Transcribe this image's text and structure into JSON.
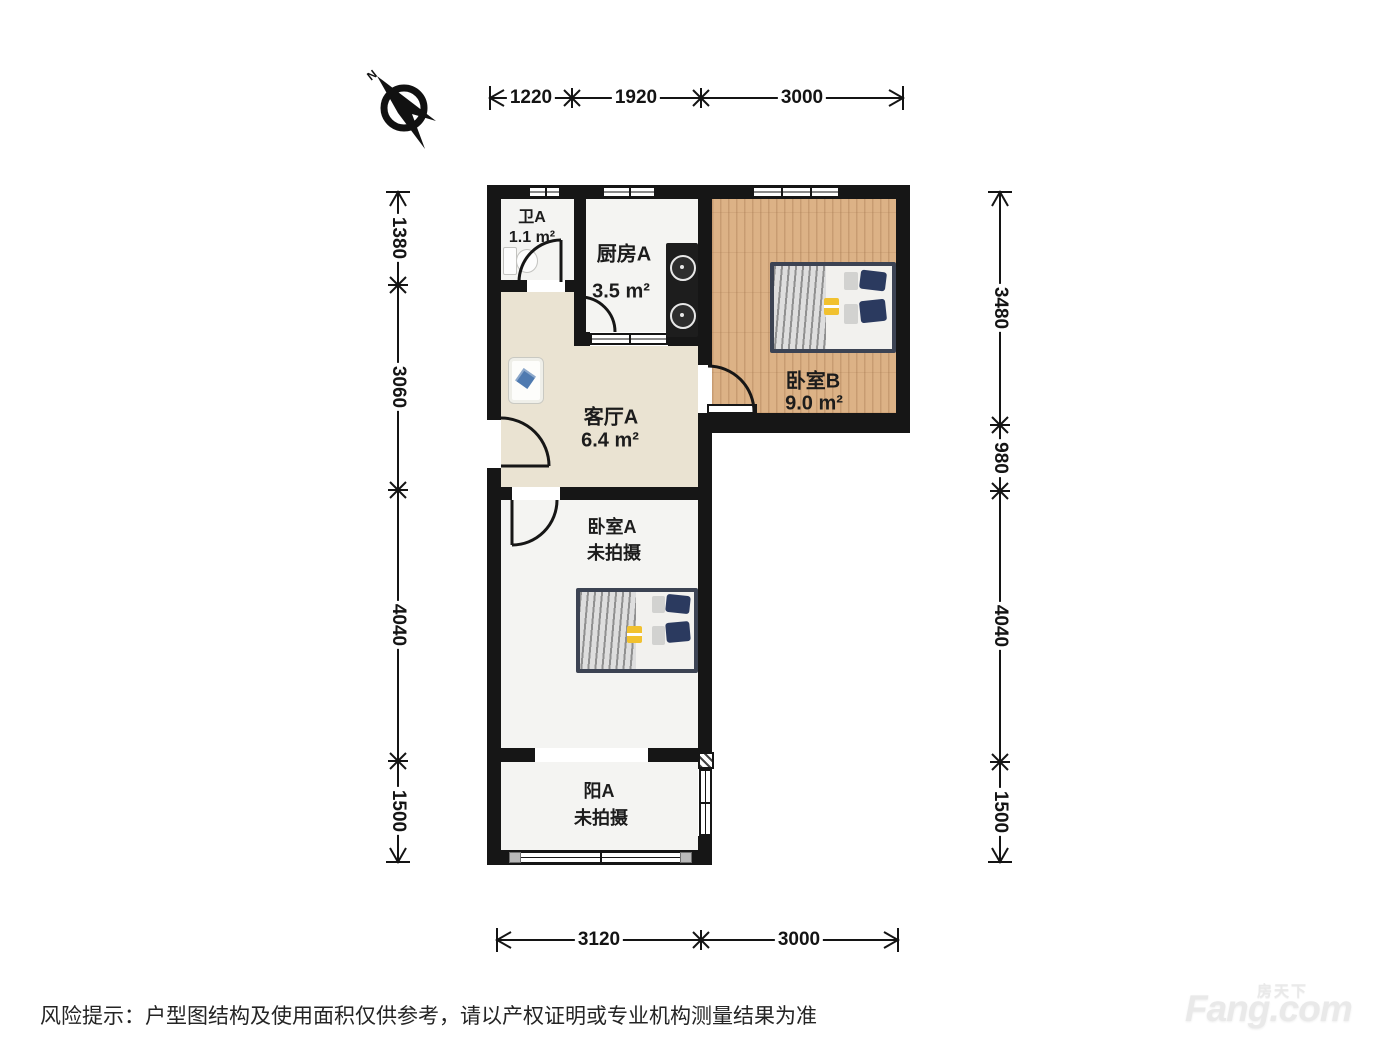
{
  "compass": {
    "label": "N"
  },
  "rooms": [
    {
      "id": "bath",
      "name": "卫A",
      "area": "1.1 m²"
    },
    {
      "id": "kitchen",
      "name": "厨房A",
      "area": "3.5 m²"
    },
    {
      "id": "bedroomB",
      "name": "卧室B",
      "area": "9.0 m²"
    },
    {
      "id": "living",
      "name": "客厅A",
      "area": "6.4 m²"
    },
    {
      "id": "bedroomA",
      "name": "卧室A",
      "area": "未拍摄"
    },
    {
      "id": "balcony",
      "name": "阳A",
      "area": "未拍摄"
    }
  ],
  "dims": {
    "top": [
      "1220",
      "1920",
      "3000"
    ],
    "left": [
      "1380",
      "3060",
      "4040",
      "1500"
    ],
    "right": [
      "3480",
      "980",
      "4040",
      "1500"
    ],
    "bottom": [
      "3120",
      "3000"
    ]
  },
  "footer": {
    "disclaimer": "风险提示：户型图结构及使用面积仅供参考，请以产权证明或专业机构测量结果为准"
  },
  "watermark": {
    "brand": "Fang.com",
    "cn": "房天下"
  },
  "colors": {
    "wall": "#161616",
    "wood_floor": "#dcb286",
    "living_floor": "#eae3d2",
    "white_floor": "#f4f4f2",
    "bed_frame": "#3c4353",
    "pillow_navy": "#2b3a5f",
    "accent_yellow": "#f1c12f",
    "sofa_cushion_blue": "#4f7ab0"
  }
}
